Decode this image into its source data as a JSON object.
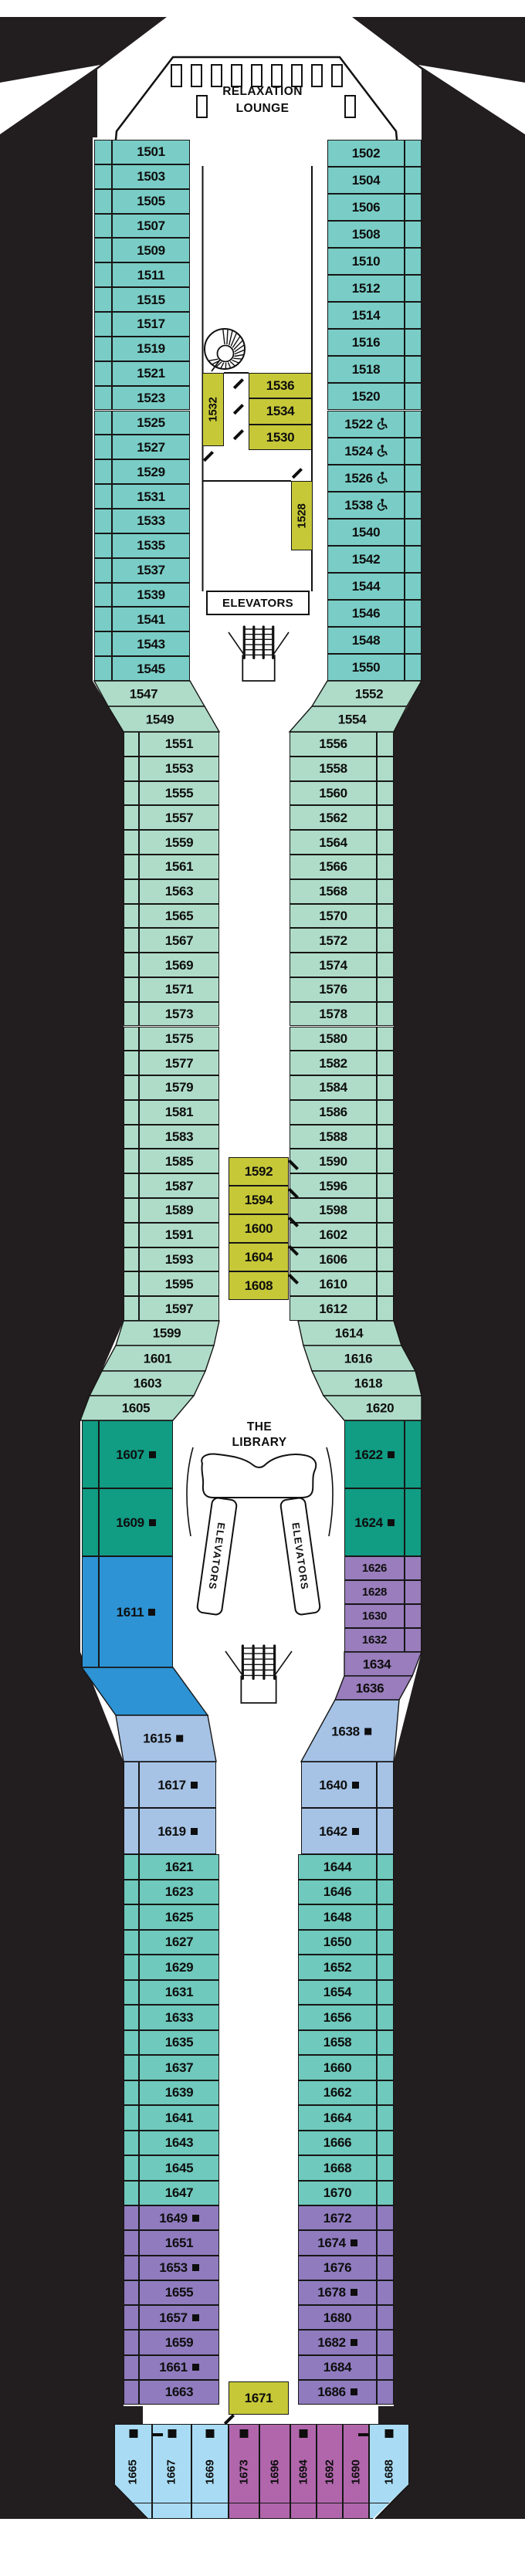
{
  "labels": {
    "relaxation": [
      "RELAXATION",
      "LOUNGE"
    ],
    "elevators": "ELEVATORS",
    "library": [
      "THE",
      "LIBRARY"
    ]
  },
  "colors": {
    "teal": "#79CDC6",
    "mint": "#AFDCC8",
    "green": "#119C84",
    "blue": "#2D93D4",
    "periwinkle": "#A6C3E6",
    "lilac": "#9A7DBC",
    "teal_low": "#6FC9BC",
    "plum": "#8F7BBE",
    "interior_yellow": "#C6C838",
    "sky": "#A9DCF4",
    "magenta": "#B166AC",
    "background": "#221D1F",
    "ink": "#0e0e0e"
  },
  "cabins": {
    "top_left": [
      "1501",
      "1503",
      "1505",
      "1507",
      "1509",
      "1511",
      "1515",
      "1517",
      "1519",
      "1521",
      "1523",
      "1525",
      "1527",
      "1529",
      "1531",
      "1533",
      "1535",
      "1537",
      "1539",
      "1541",
      "1543",
      "1545"
    ],
    "top_right": [
      {
        "n": "1502"
      },
      {
        "n": "1504"
      },
      {
        "n": "1506"
      },
      {
        "n": "1508"
      },
      {
        "n": "1510"
      },
      {
        "n": "1512"
      },
      {
        "n": "1514"
      },
      {
        "n": "1516"
      },
      {
        "n": "1518"
      },
      {
        "n": "1520"
      },
      {
        "n": "1522",
        "acc": true
      },
      {
        "n": "1524",
        "acc": true
      },
      {
        "n": "1526",
        "acc": true
      },
      {
        "n": "1538",
        "acc": true
      },
      {
        "n": "1540"
      },
      {
        "n": "1542"
      },
      {
        "n": "1544"
      },
      {
        "n": "1546"
      },
      {
        "n": "1548"
      },
      {
        "n": "1550"
      }
    ],
    "top_interior": [
      {
        "n": "1532",
        "vert": true
      },
      {
        "n": "1536"
      },
      {
        "n": "1534"
      },
      {
        "n": "1530"
      },
      {
        "n": "1528",
        "vert": true
      }
    ],
    "mid_left_head": [
      "1547",
      "1549"
    ],
    "mid_left": [
      "1551",
      "1553",
      "1555",
      "1557",
      "1559",
      "1561",
      "1563",
      "1565",
      "1567",
      "1569",
      "1571",
      "1573",
      "1575",
      "1577",
      "1579",
      "1581",
      "1583",
      "1585",
      "1587",
      "1589",
      "1591",
      "1593",
      "1595",
      "1597"
    ],
    "mid_left_tail": [
      "1599",
      "1601",
      "1603",
      "1605"
    ],
    "mid_right_head": [
      "1552",
      "1554"
    ],
    "mid_right": [
      "1556",
      "1558",
      "1560",
      "1562",
      "1564",
      "1566",
      "1568",
      "1570",
      "1572",
      "1574",
      "1576",
      "1578",
      "1580",
      "1582",
      "1584",
      "1586",
      "1588",
      "1590",
      "1596",
      "1598",
      "1602",
      "1606",
      "1610",
      "1612"
    ],
    "mid_right_tail": [
      "1614",
      "1616",
      "1618",
      "1620"
    ],
    "mid_interior": [
      "1592",
      "1594",
      "1600",
      "1604",
      "1608"
    ],
    "suites_left": [
      {
        "n": "1607",
        "sq": true
      },
      {
        "n": "1609",
        "sq": true
      }
    ],
    "blue_suite": {
      "n": "1611",
      "sq": true
    },
    "ltblue_left": [
      {
        "n": "1615",
        "sq": true
      },
      {
        "n": "1617",
        "sq": true
      },
      {
        "n": "1619",
        "sq": true
      }
    ],
    "suites_right": [
      {
        "n": "1622",
        "sq": true
      },
      {
        "n": "1624",
        "sq": true
      }
    ],
    "purple_stack_right": [
      "1626",
      "1628",
      "1630",
      "1632",
      "1634",
      "1636"
    ],
    "ltblue_right": [
      {
        "n": "1638",
        "sq": true
      },
      {
        "n": "1640",
        "sq": true
      },
      {
        "n": "1642",
        "sq": true
      }
    ],
    "low_left_teal": [
      "1621",
      "1623",
      "1625",
      "1627",
      "1629",
      "1631",
      "1633",
      "1635",
      "1637",
      "1639",
      "1641",
      "1643",
      "1645",
      "1647"
    ],
    "low_right_teal": [
      "1644",
      "1646",
      "1648",
      "1650",
      "1652",
      "1654",
      "1656",
      "1658",
      "1660",
      "1662",
      "1664",
      "1666",
      "1668",
      "1670"
    ],
    "low_left_purple": [
      {
        "n": "1649",
        "sq": true
      },
      {
        "n": "1651"
      },
      {
        "n": "1653",
        "sq": true
      },
      {
        "n": "1655"
      },
      {
        "n": "1657",
        "sq": true
      },
      {
        "n": "1659"
      },
      {
        "n": "1661",
        "sq": true
      },
      {
        "n": "1663"
      }
    ],
    "low_right_purple": [
      {
        "n": "1672"
      },
      {
        "n": "1674",
        "sq": true
      },
      {
        "n": "1676"
      },
      {
        "n": "1678",
        "sq": true
      },
      {
        "n": "1680"
      },
      {
        "n": "1682",
        "sq": true
      },
      {
        "n": "1684"
      },
      {
        "n": "1686",
        "sq": true
      }
    ],
    "interior_aft": {
      "n": "1671"
    },
    "stern": [
      {
        "n": "1665",
        "sq": true,
        "c": "sky"
      },
      {
        "n": "1667",
        "sq": true,
        "c": "sky"
      },
      {
        "n": "1669",
        "sq": true,
        "c": "sky"
      },
      {
        "n": "1673",
        "sq": true,
        "c": "magenta"
      },
      {
        "n": "1696",
        "c": "magenta"
      },
      {
        "n": "1694",
        "sq": true,
        "c": "magenta"
      },
      {
        "n": "1692",
        "c": "magenta"
      },
      {
        "n": "1690",
        "c": "magenta"
      },
      {
        "n": "1688",
        "sq": true,
        "c": "sky"
      }
    ]
  }
}
